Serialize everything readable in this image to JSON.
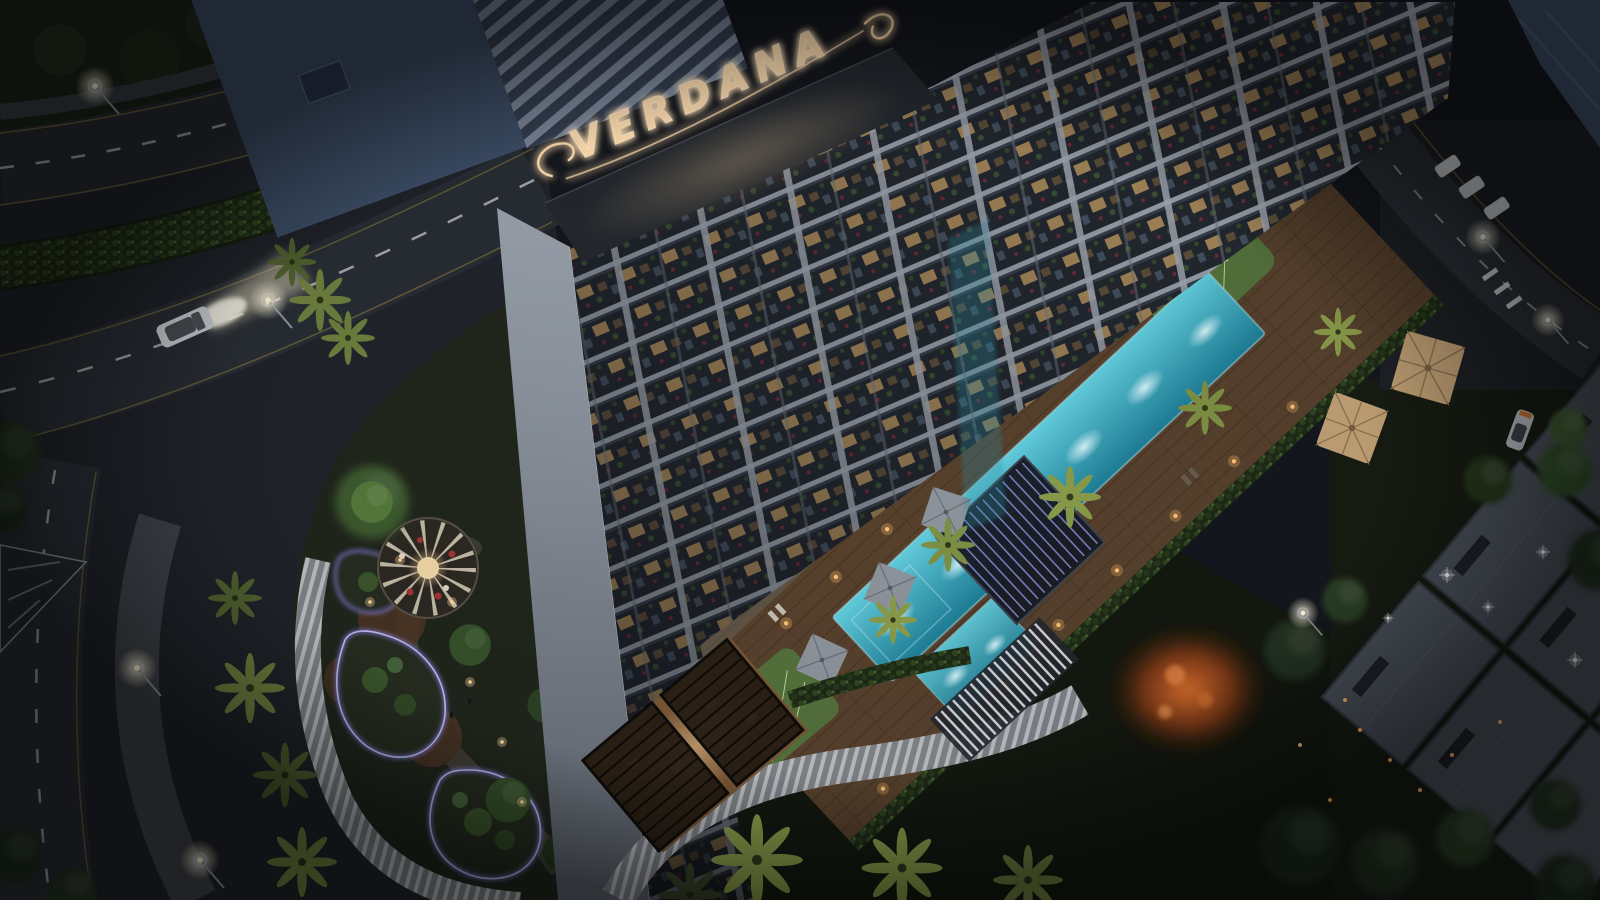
{
  "scene": {
    "sign": {
      "text": "VERDANA"
    },
    "palette": {
      "night_ground": "#14171d",
      "road_asphalt": "#282d34",
      "road_marking_white": "#c9ced3",
      "road_marking_yellow": "#7c6c3c",
      "roof_slab_blue": "#3e4f68",
      "parapet_dark": "#24282e",
      "facade_light": "#aeb6c1",
      "balcony_dark": "#262b33",
      "window_warm": "#d9ae6e",
      "neon_amber": "#ffdcae",
      "pool_teal_light": "#63cede",
      "pool_teal_deep": "#1d7e97",
      "pergola_led": "#8d8fd8",
      "deck_wood": "#57412d",
      "deck_light_warm": "#ffc277",
      "lawn_green": "#54713c",
      "hedge_green": "#1d2a16",
      "palm_lit": "#8a9c4a",
      "palm_dark": "#39452a",
      "led_path_violet": "#8b86f0",
      "autumn_orange": "#e0722e",
      "villa_roof_gray": "#4c535d",
      "car_body": "#c9cdd2",
      "taillight_red": "#d8354a"
    },
    "elements": [
      "residential-tower",
      "rooftop-neon-sign",
      "metal-roof",
      "amenity-pool-deck",
      "swimming-pool",
      "kids-pool",
      "pool-pergola",
      "sun-umbrellas",
      "putting-green",
      "landscaped-garden",
      "garden-gazebo",
      "led-pathways",
      "street-roads",
      "street-lamps",
      "moving-car",
      "parked-cars",
      "palm-trees",
      "villa-roofs",
      "autumn-tree"
    ]
  }
}
